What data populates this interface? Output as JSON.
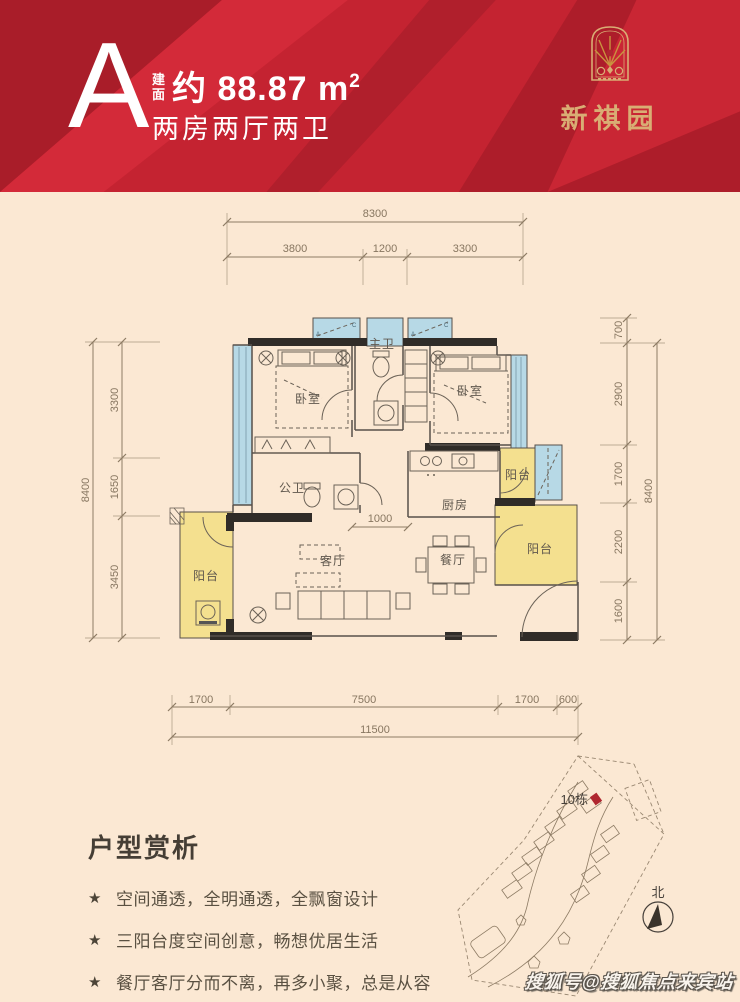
{
  "banner": {
    "unit_type": "A",
    "area_prefix_top": "建",
    "area_prefix_bottom": "面",
    "area_value": "约 88.87 m",
    "area_sup": "2",
    "layout_text": "两房两厅两卫",
    "logo_name": "新祺园"
  },
  "plan": {
    "rooms": {
      "bedroom_left": "卧室",
      "bedroom_right": "卧室",
      "master_bath": "主卫",
      "public_bath": "公卫",
      "kitchen": "厨房",
      "living": "客厅",
      "dining": "餐厅",
      "balcony_left": "阳台",
      "balcony_right_top": "阳台",
      "balcony_right_bottom": "阳台"
    },
    "ac": {
      "a": "A",
      "c": "C"
    },
    "dims": {
      "top_total": "8300",
      "top_segments": [
        "3800",
        "1200",
        "3300"
      ],
      "left_total": "8400",
      "left_segments": [
        "3300",
        "1650",
        "3450"
      ],
      "right_total": "8400",
      "right_segments": [
        "700",
        "2900",
        "1700",
        "2200",
        "1600"
      ],
      "bottom_total": "11500",
      "bottom_segments": [
        "1700",
        "7500",
        "1700",
        "600"
      ],
      "inner_width": "1000"
    }
  },
  "analysis": {
    "title": "户型赏析",
    "star": "★",
    "bullets": [
      "空间通透，全明通透，全飘窗设计",
      "三阳台度空间创意，畅想优居生活",
      "餐厅客厅分而不离，再多小聚，总是从容"
    ]
  },
  "sitemap": {
    "building_label": "10栋",
    "north_label": "北"
  },
  "watermark": "搜狐号@搜狐焦点来宾站",
  "colors": {
    "banner_red": "#c42331",
    "gold": "#d9ad74",
    "cream": "#fbe8d3",
    "bay_blue": "#b7d9e6",
    "balcony_yellow": "#f4e08f",
    "wall_black": "#302c28",
    "marker_red": "#b02730"
  }
}
